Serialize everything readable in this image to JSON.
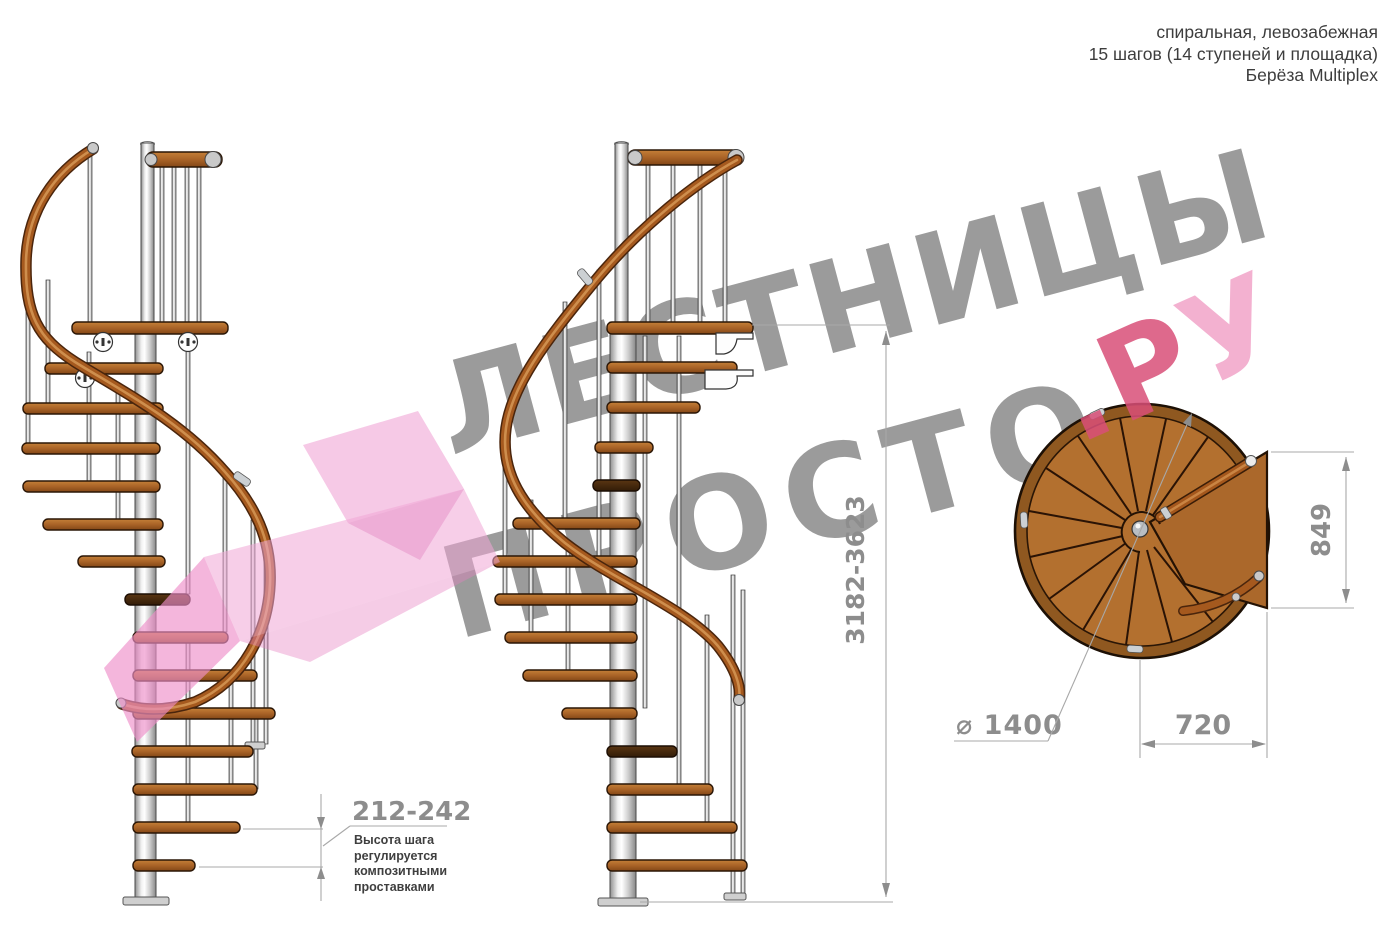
{
  "header": {
    "line1": "спиральная, левозабежная",
    "line2": "15 шагов (14 ступеней и площадка)",
    "line3": "Берёза Multiplex"
  },
  "watermark": {
    "line1": "ЛЕСТНИЦЫ",
    "line2": "ПРОСТО",
    "suffix_dark": ".Р",
    "suffix_light": "У",
    "gray_color": "#9b9b9b",
    "pink_dark": "#d94f78",
    "pink_light": "#f2a9cc",
    "arrow_pink": "#ee8fc9"
  },
  "dimensions": {
    "total_height": "3182-3623",
    "step_height": "212-242",
    "note_lines": [
      "Высота шага",
      "регулируется",
      "композитными",
      "проставками"
    ],
    "platform_side": "849",
    "platform_width": "720",
    "diameter": "⌀ 1400"
  },
  "colors": {
    "wood": "#a96327",
    "wood_plan": "#b3702f",
    "metal": "#c9c9c9",
    "dimension_gray": "#8d8d8d",
    "text_dark": "#3d3d3d"
  }
}
